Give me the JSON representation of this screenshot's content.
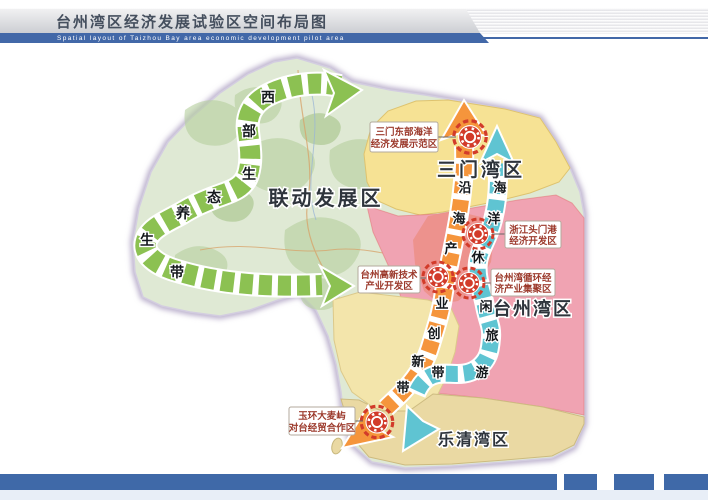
{
  "header": {
    "title": "台州湾区经济发展试验区空间布局图",
    "subtitle": "Spatial layout of Taizhou Bay area economic development pilot area"
  },
  "map": {
    "region_labels": {
      "linkage": "联动发展区",
      "sanmen": "三门湾区",
      "taizhou": "台州湾区",
      "yueqing": "乐清湾区"
    },
    "belts": {
      "west": {
        "name": "西部生态养生带",
        "chars": [
          "西",
          "部",
          "生",
          "态",
          "养",
          "生",
          "带"
        ]
      },
      "industry": {
        "name": "沿海产业创新带",
        "chars": [
          "沿",
          "海",
          "产",
          "业",
          "创",
          "新",
          "带"
        ]
      },
      "leisure": {
        "name": "海洋休闲旅游带",
        "chars": [
          "海",
          "洋",
          "休",
          "闲",
          "旅",
          "游",
          "带"
        ]
      }
    },
    "zones": [
      {
        "name": "三门东部海洋经济发展示范区",
        "line1": "三门东部海洋",
        "line2": "经济发展示范区"
      },
      {
        "name": "浙江头门港经济开发区",
        "line1": "浙江头门港",
        "line2": "经济开发区"
      },
      {
        "name": "台州高新技术产业开发区",
        "line1": "台州高新技术",
        "line2": "产业开发区"
      },
      {
        "name": "台州湾循环经济产业集聚区",
        "line1": "台州湾循环经",
        "line2": "济产业集聚区"
      },
      {
        "name": "玉环大麦屿对台经贸合作区",
        "line1": "玉环大麦屿",
        "line2": "对台经贸合作区"
      }
    ]
  },
  "colors": {
    "header_bar": "#4268a8",
    "footer_bar": "#3f69a8",
    "west_belt": "#8cc152",
    "industry_belt": "#f5953c",
    "leisure_belt": "#5fc4d2",
    "sanmen_region": "#f6e294",
    "taizhou_region": "#f0a3b2",
    "taizhou_urban": "#ec8f86",
    "corridor_region": "#f3e5ab",
    "yueqing_region": "#ead9a3",
    "poi_red": "#d23b2a",
    "terrain_green": "#dfe9d4"
  }
}
